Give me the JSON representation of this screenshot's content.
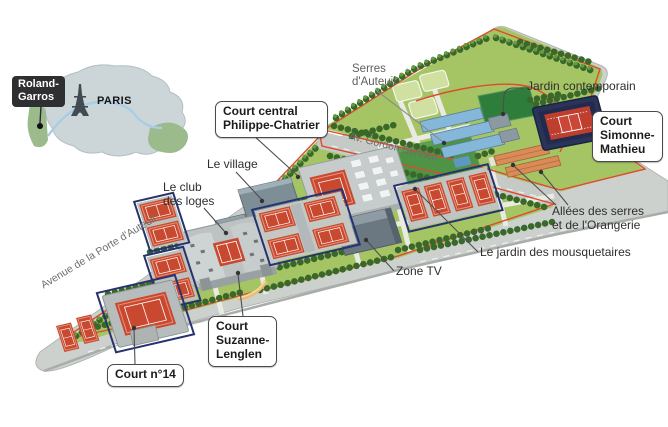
{
  "inset": {
    "site_label": "Roland-\nGarros",
    "city_label": "PARIS"
  },
  "map_labels": {
    "serres": "Serres\nd'Auteuil",
    "jardin_contemporain": "Jardin contemporain",
    "court_chatrier": "Court central\nPhilippe-Chatrier",
    "court_simonne": "Court\nSimonne-\nMathieu",
    "village": "Le village",
    "club_loges": "Le club\ndes loges",
    "allees": "Allées des serres\net de l'Orangerie",
    "mousquetaires": "Le jardin des mousquetaires",
    "zone_tv": "Zone TV",
    "court_lenglen": "Court\nSuzanne-\nLenglen",
    "court_14": "Court n°14",
    "av_gordon": "Av. Gordon Bennett",
    "av_auteuil": "Avenue de la Porte d'Auteuil"
  },
  "colors": {
    "boundary_line": "#e04a2f",
    "lawn_green": "#a5c464",
    "clay_court_red": "#c8492f",
    "navy_fence": "#27336e",
    "pavement_gray": "#cdd1cd",
    "greenhouse_blue": "#85b7da",
    "contemporain_green": "#2e7d3b",
    "orangerie_orange": "#d98b58",
    "label_box_dark": "#2f2f31",
    "paris_map_fill": "#ccd6d9"
  }
}
